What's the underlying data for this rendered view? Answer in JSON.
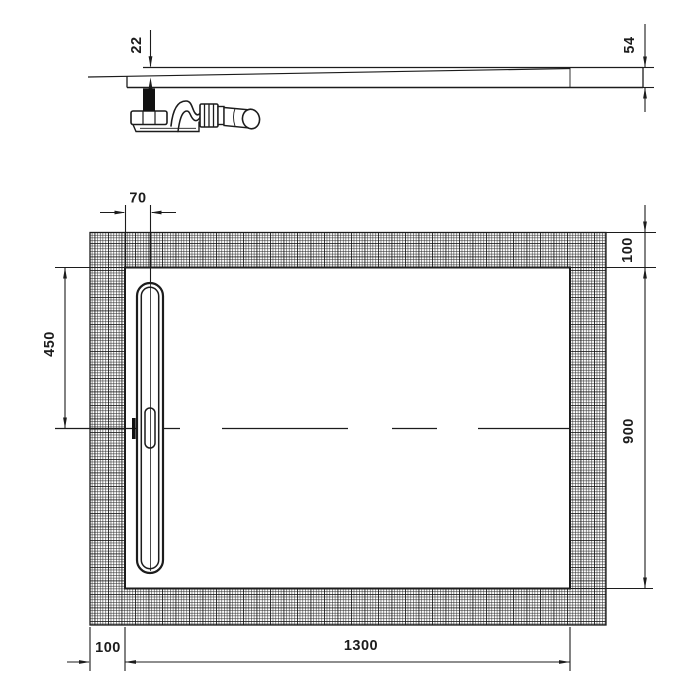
{
  "drawing": {
    "type": "technical-drawing-shower-tray",
    "colors": {
      "line": "#1c1c1c",
      "background": "#ffffff"
    },
    "side_view": {
      "depth_at_drain": "22",
      "edge_height": "54"
    },
    "plan_view": {
      "drain_offset_from_edge": "70",
      "drain_center_from_top": "450",
      "border_top": "100",
      "inner_length_vertical": "900",
      "border_left": "100",
      "inner_length_horizontal": "1300"
    }
  }
}
